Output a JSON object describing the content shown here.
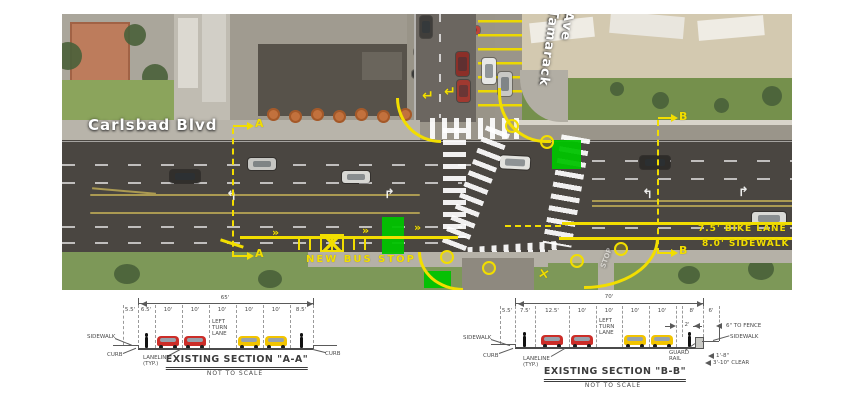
{
  "aerial": {
    "labels": {
      "main_street": "Carlsbad  Blvd",
      "cross_street_1": "Tamarack",
      "cross_street_2": "Ave",
      "new_bus_stop": "NEW BUS STOP",
      "bike_lane": "7.5' BIKE LANE",
      "sidewalk": "8.0' SIDEWALK",
      "section_a": "A",
      "section_b": "B",
      "stop_pavement": "STOP"
    },
    "glyphs": {
      "chevron": "»",
      "arrow_up_left": "↰",
      "arrow_up_right": "↱",
      "return_arrow": "↵",
      "cross": "×"
    },
    "colors": {
      "annotation_yellow": "#f2de00",
      "highlight_green": "#00c300"
    }
  },
  "section_aa": {
    "title": "EXISTING SECTION \"A-A\"",
    "not_to_scale": "NOT TO SCALE",
    "overall": "65'",
    "dims": [
      "5.5'",
      "6.5'",
      "10'",
      "10'",
      "10'",
      "10'",
      "10'",
      "8.5'"
    ],
    "lane_label": {
      "l1": "LEFT",
      "l2": "TURN",
      "l3": "LANE"
    },
    "callouts": {
      "sidewalk": "SIDEWALK",
      "curb_left": "CURB",
      "laneline1": "LANELINE",
      "laneline2": "(TYP.)",
      "curb_right": "CURB"
    }
  },
  "section_bb": {
    "title": "EXISTING SECTION \"B-B\"",
    "not_to_scale": "NOT TO SCALE",
    "overall": "70'",
    "dims": [
      "5.5'",
      "7.5'",
      "12.5'",
      "10'",
      "10'",
      "10'",
      "10'",
      "8'",
      "6'"
    ],
    "lane_label": {
      "l1": "LEFT",
      "l2": "TURN",
      "l3": "LANE"
    },
    "callouts": {
      "sidewalk": "SIDEWALK",
      "curb_left": "CURB",
      "laneline1": "LANELINE",
      "laneline2": "(TYP.)",
      "guard1": "GUARD",
      "guard2": "RAIL",
      "two_ft": "2'",
      "to_fence": "6\" TO FENCE",
      "sidewalk_right": "SIDEWALK",
      "clear_a": "1'-8\"",
      "clear_b": "3'-10\" CLEAR"
    }
  }
}
